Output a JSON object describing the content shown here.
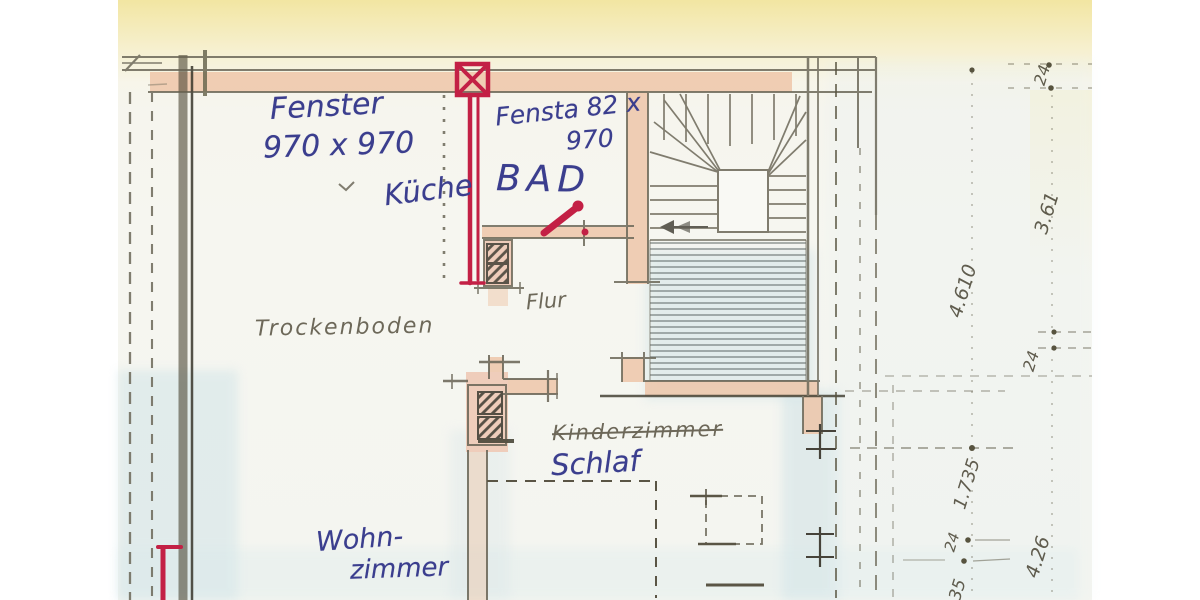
{
  "plan": {
    "rooms": {
      "trockenboden": "Trockenboden",
      "kueche": "Küche",
      "bad": "BAD",
      "flur": "Flur",
      "kinderzimmer": "Kinderzimmer",
      "schlaf": "Schlaf",
      "wohnzimmer_line1": "Wohn-",
      "wohnzimmer_line2": "zimmer"
    },
    "windows": {
      "fenster1_label": "Fenster",
      "fenster1_size": "970 x 970",
      "fenster2_label": "Fensta 82 x",
      "fenster2_size": "970"
    },
    "dimensions": {
      "d24_top": "24",
      "d3_61": "3.61",
      "d4_610": "4.610",
      "d24_mid": "24",
      "d1_735": "1.735",
      "d24_low": "24",
      "d4_26": "4.26",
      "d35": "35"
    },
    "colors": {
      "ink_blue": "#3b3e8e",
      "pencil": "#5a5544",
      "marker_red": "#c32045",
      "wall_pink": "#eec4a5",
      "wash_blue": "#cfe3e7",
      "paper_yellow": "#f2e59e"
    }
  }
}
